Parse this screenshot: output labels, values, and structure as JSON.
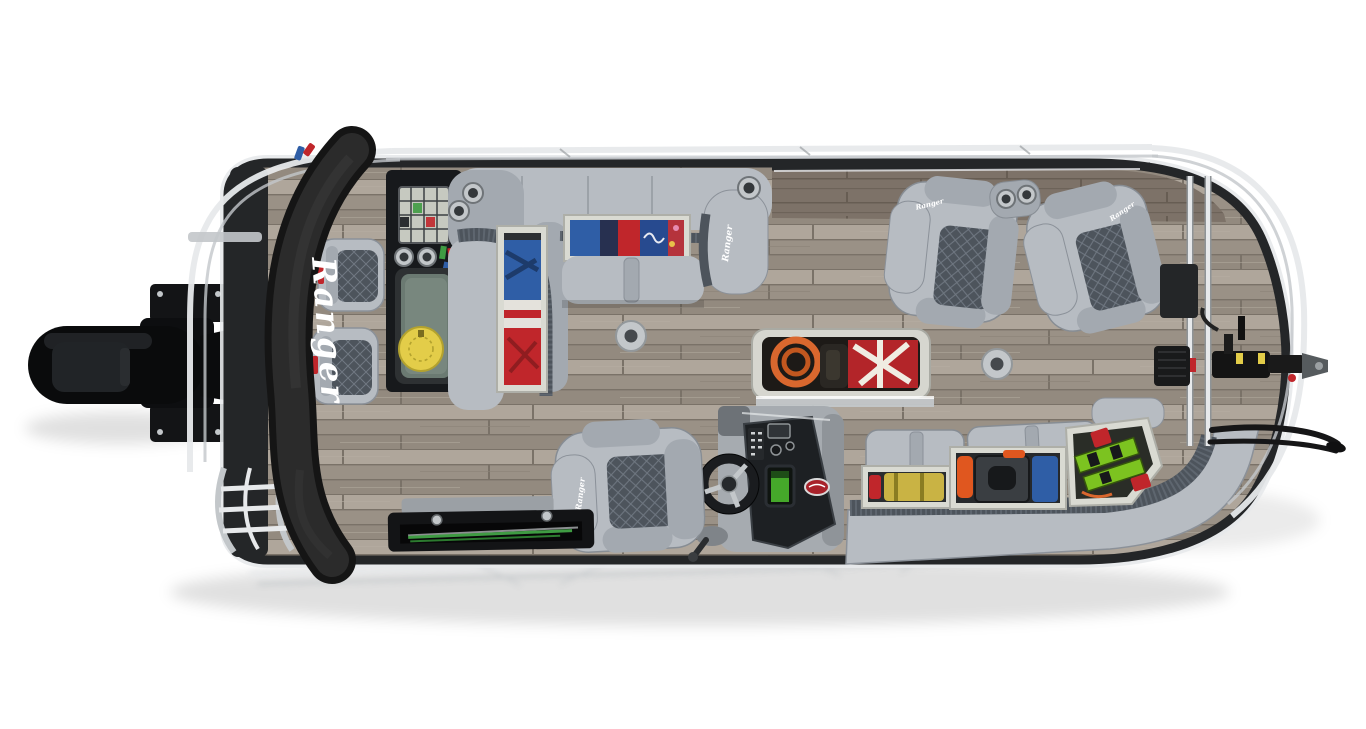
{
  "scene": {
    "description": "Overhead top-down product photo of a Ranger pontoon fishing boat on a white studio background: black outboard motor at stern (left), rolled black bimini with Ranger logo, gray quilted seating, wood-look vinyl deck, helm console with steering wheel, open storage compartments with colorful gear, bow trailer coupler and trolling motor at right",
    "background_color": "#ffffff"
  },
  "branding": {
    "logo": "Ranger",
    "bimini_logo": "Ranger",
    "seat_logo": "Ranger"
  },
  "palette": {
    "bg": "#ffffff",
    "shadow": "#d7d7d7",
    "wood_base": "#a79e93",
    "wood_light": "#b6ada2",
    "wood_mid": "#9a9186",
    "wood_dark": "#8b8277",
    "wood_gap": "#7a7268",
    "side_wood": "#7d7268",
    "side_wood_dark": "#675d53",
    "seat": "#b7bcc2",
    "seat_mid": "#a3a9b0",
    "seat_dark": "#8b9199",
    "seat_edge": "#70767e",
    "quilt_bg": "#4d545c",
    "quilt_line": "#707882",
    "black": "#131416",
    "soft_black": "#242628",
    "panel_black": "#1d2023",
    "console_gray": "#a6abb0",
    "chrome": "#e7e9eb",
    "chrome_mid": "#c3c7ca",
    "chrome_dark": "#8e9396",
    "rim_white": "#e6e6e0",
    "red": "#c0262b",
    "yellow": "#e3cd49",
    "blue": "#2f5ea6",
    "navy": "#273050",
    "orange": "#e0571f",
    "lime": "#7cc320",
    "green": "#3f9b43",
    "livewell": "#6b7a72",
    "screen_green": "#4fc22f"
  }
}
